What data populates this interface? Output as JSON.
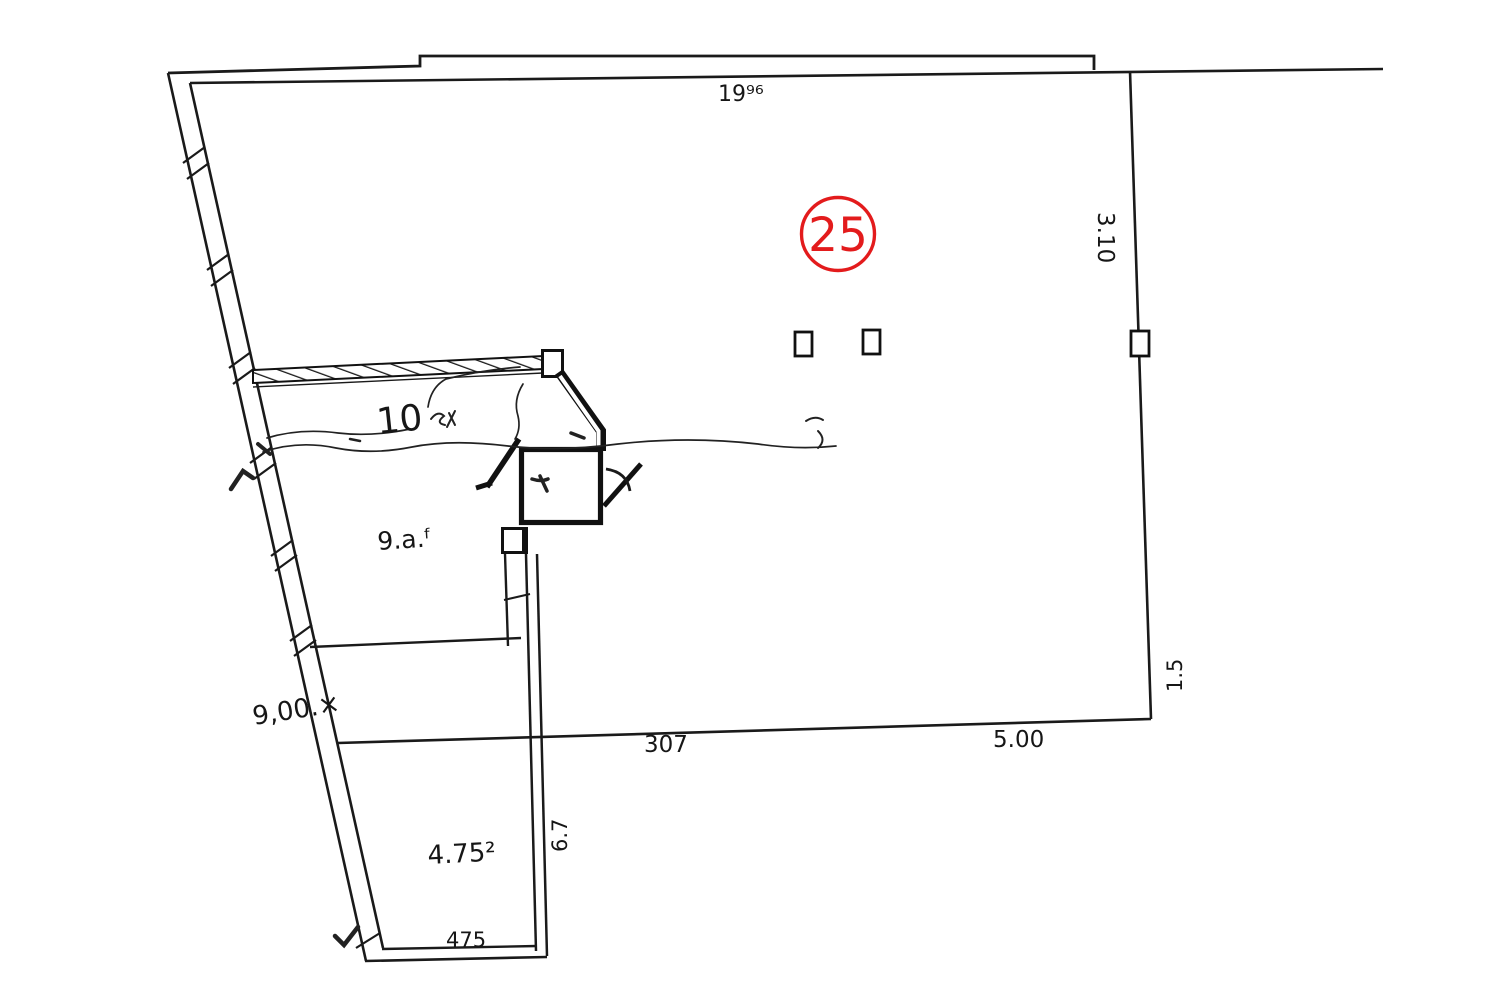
{
  "page": {
    "background": "#ffffff",
    "ink_color": "#1a1a1a",
    "accent_red": "#e31b1c"
  },
  "plan": {
    "parcel_number": "25",
    "labels": {
      "top_width": "19⁹⁶",
      "right_height": "3.10",
      "right_offset": "1.5",
      "bottom_inner_width": "307",
      "bottom_right_width": "5.00",
      "left_boundary_length": "9,00.×",
      "upper_room_area": "10",
      "middle_room_area": "9.a.ᶠ",
      "lower_room_area": "4.75²",
      "lower_room_width": "475",
      "corridor_width": "6.7"
    }
  }
}
